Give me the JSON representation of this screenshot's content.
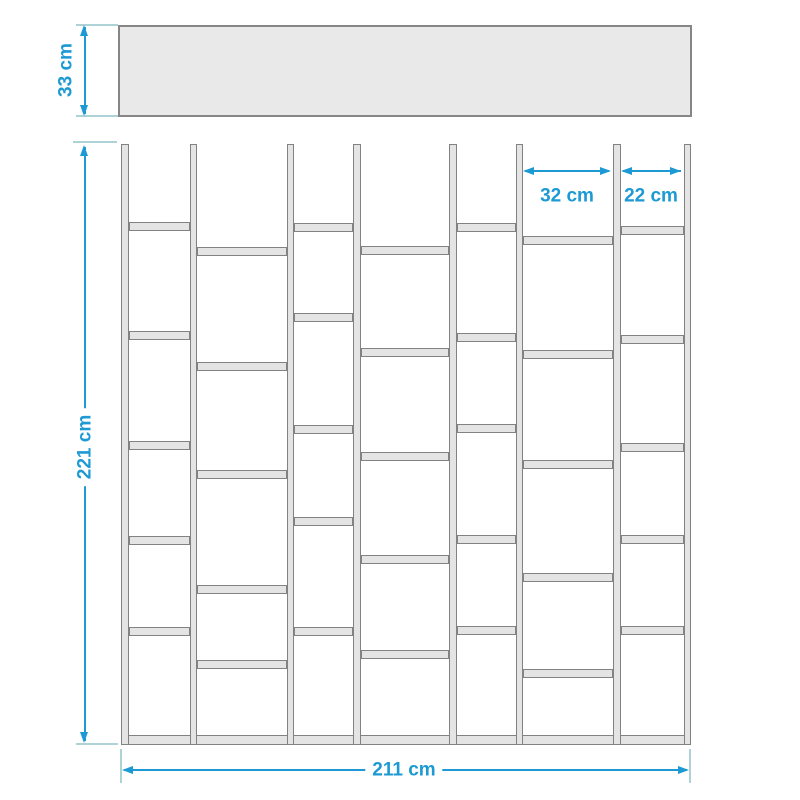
{
  "diagram": {
    "type": "furniture-dimension-drawing",
    "subject": "staggered open bookshelf / room divider, front view with top-view depth panel",
    "unit": "cm"
  },
  "dimensions": {
    "depth": "33 cm",
    "height": "221 cm",
    "wide_bay": "32 cm",
    "narrow_bay": "22 cm",
    "width": "211 cm"
  },
  "colors": {
    "dimension": "#1d9ad3",
    "extension": "#aed3d6",
    "panel_fill": "#e9e9e9",
    "panel_border": "#868686",
    "wood_fill": "#e4e4e4",
    "wood_border": "#828282",
    "background": "#ffffff"
  },
  "figure": {
    "top_panel": {
      "left": 118,
      "top": 25,
      "width": 574,
      "height": 92
    },
    "shelf": {
      "left": 121,
      "top": 144,
      "width": 570,
      "height": 601,
      "post_width": 7.5,
      "posts_x": [
        121,
        189.5,
        286.5,
        353,
        449,
        515.5,
        613,
        683.5
      ],
      "shelf_thickness": 9,
      "bottom_bar_y": 735,
      "bays": [
        {
          "x1": 128.5,
          "x2": 189.5,
          "width_cm": 22,
          "shelves_y": [
            222,
            331,
            441,
            536,
            627
          ]
        },
        {
          "x1": 197.0,
          "x2": 286.5,
          "width_cm": 32,
          "shelves_y": [
            247,
            362,
            470,
            585,
            660
          ]
        },
        {
          "x1": 294.0,
          "x2": 353.0,
          "width_cm": 22,
          "shelves_y": [
            223,
            313,
            425,
            517,
            627
          ]
        },
        {
          "x1": 360.5,
          "x2": 449.0,
          "width_cm": 32,
          "shelves_y": [
            246,
            348,
            452,
            555,
            650
          ]
        },
        {
          "x1": 456.5,
          "x2": 515.5,
          "width_cm": 22,
          "shelves_y": [
            223,
            333,
            424,
            535,
            626
          ]
        },
        {
          "x1": 523.0,
          "x2": 613.0,
          "width_cm": 32,
          "shelves_y": [
            236,
            350,
            460,
            573,
            669
          ]
        },
        {
          "x1": 620.5,
          "x2": 683.5,
          "width_cm": 22,
          "shelves_y": [
            226,
            335,
            443,
            535,
            626
          ]
        }
      ]
    }
  }
}
